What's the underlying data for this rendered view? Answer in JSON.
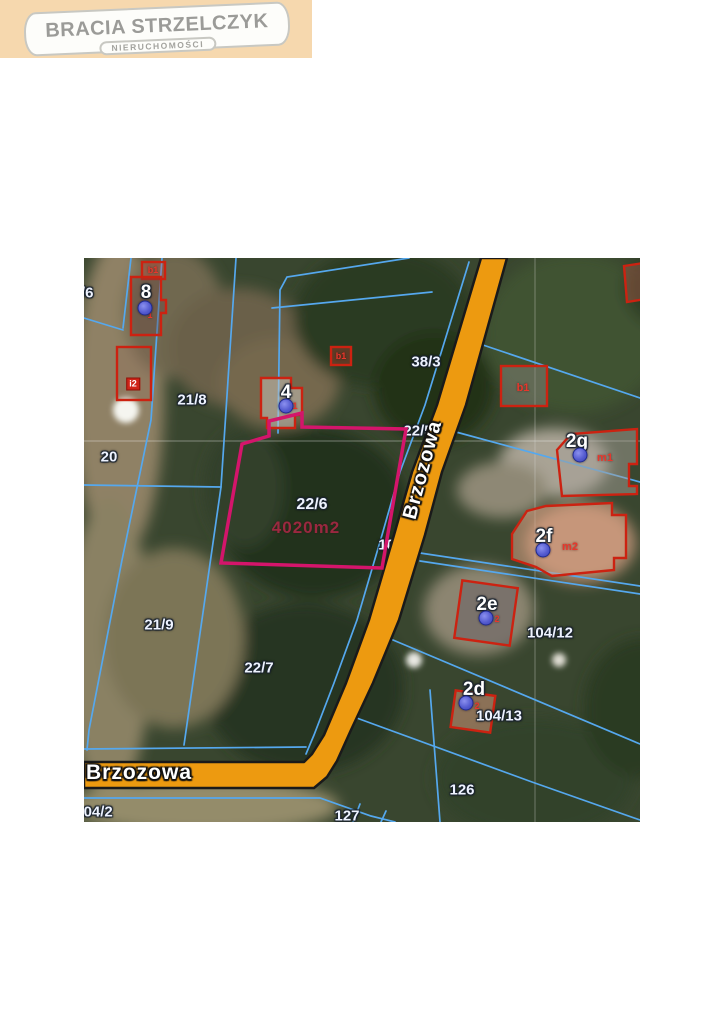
{
  "logo": {
    "title": "BRACIA STRZELCZYK",
    "subtitle": "NIERUCHOMOŚCI"
  },
  "map": {
    "street_label_vertical": "Brzozowa",
    "street_label_horizontal": "Brzozowa",
    "highlighted_parcel": {
      "number": "22/6",
      "area_label": "4020m2"
    },
    "labels": {
      "p9_6": "9/6",
      "p8": "8",
      "p21_8": "21/8",
      "p20": "20",
      "p21_9": "21/9",
      "p22_7": "22/7",
      "p22_5": "22/5",
      "p38_3": "38/3",
      "p104_9": "104/9",
      "p104_12": "104/12",
      "p104_13": "104/13",
      "p126": "126",
      "p127": "127",
      "p104_2": "104/2",
      "p4": "4",
      "p2g": "2g",
      "p2f": "2f",
      "p2e": "2e",
      "p2d": "2d",
      "b1_topleft": "b1",
      "b1_mid": "b1",
      "b1_right": "b1",
      "i2": "i2",
      "m1": "m1",
      "m2": "m2",
      "sub8": "1",
      "sub4": "1",
      "sub2e": "2",
      "sub2d": "2"
    }
  },
  "colors": {
    "highlight_pink": "#d4156b",
    "road_orange": "#ed9a10",
    "parcel_line_blue": "#55a8ee",
    "building_outline_red": "#cc2211",
    "logo_background": "#f6d8ae"
  }
}
